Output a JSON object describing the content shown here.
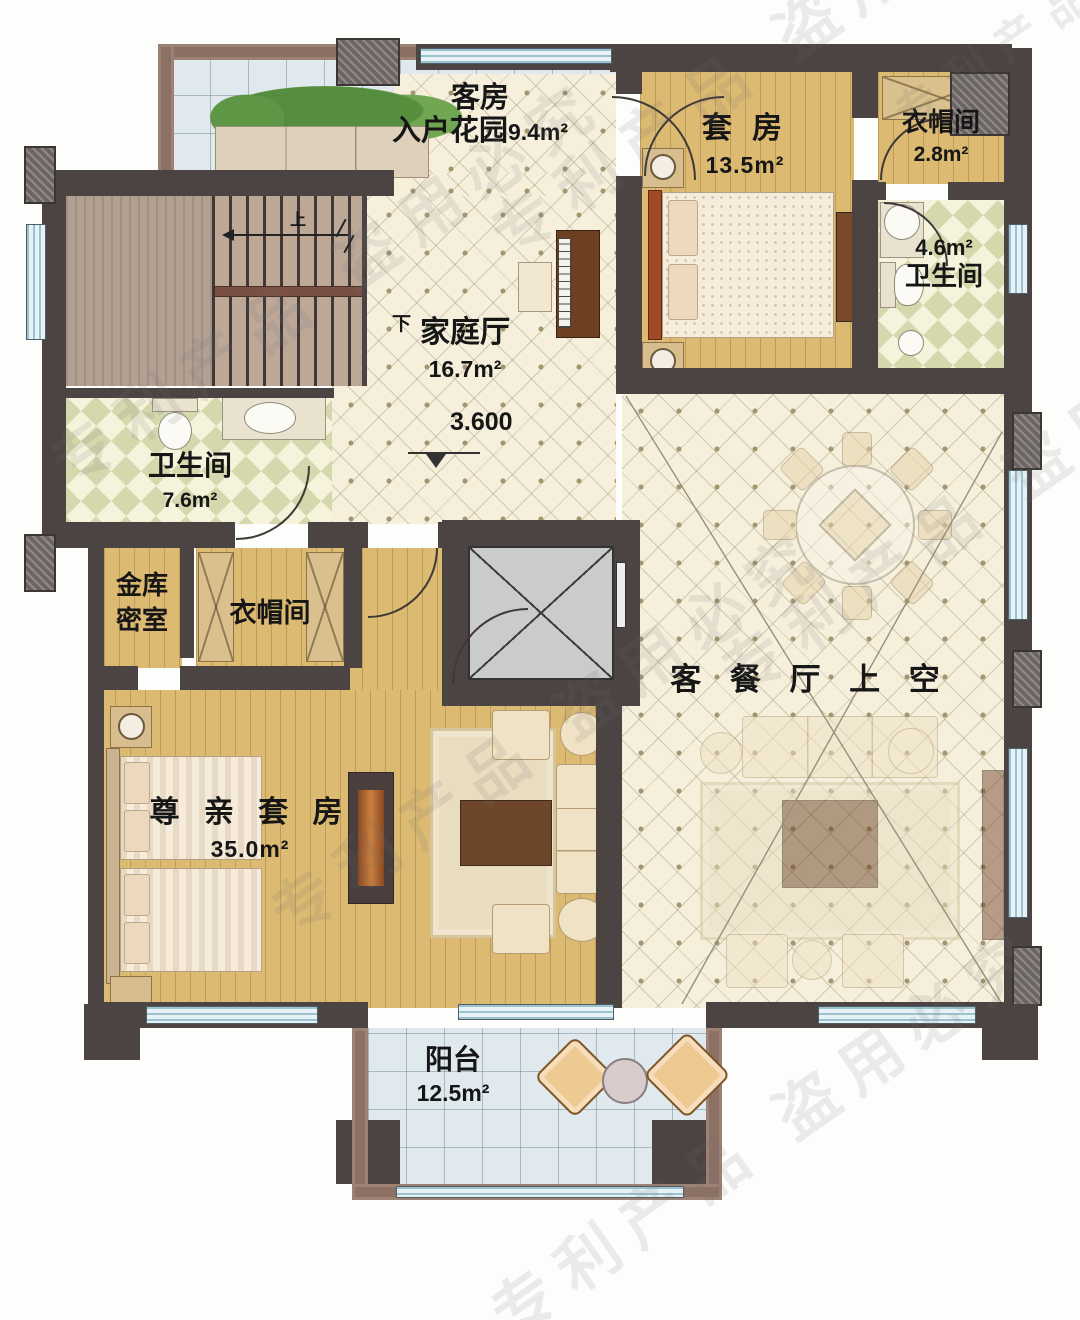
{
  "plan": {
    "rooms": {
      "entry_garden": {
        "line1": "客房",
        "line2": "入户花园",
        "area": "9.4m²"
      },
      "suite": {
        "name": "套 房",
        "area": "13.5m²"
      },
      "cloak_top": {
        "name": "衣帽间",
        "area": "2.8m²"
      },
      "bath_right": {
        "name": "卫生间",
        "area": "4.6m²"
      },
      "family_hall": {
        "name": "家庭厅",
        "area": "16.7m²",
        "level": "3.600"
      },
      "bath_left": {
        "name": "卫生间",
        "area": "7.6m²"
      },
      "vault": {
        "line1": "金库",
        "line2": "密室"
      },
      "cloak_mid": {
        "name": "衣帽间"
      },
      "elder_suite": {
        "name": "尊 亲 套 房",
        "area": "35.0m²"
      },
      "void": {
        "name": "客 餐 厅 上 空"
      },
      "balcony": {
        "name": "阳台",
        "area": "12.5m²"
      }
    },
    "stairs": {
      "up": "上",
      "down": "下"
    },
    "watermark": "专利产品 盗用必究"
  },
  "colors": {
    "wall": "#4c4442",
    "parapet": "#8b7164",
    "wood_floor": "#dcba72",
    "cream_tile": "#f5efdc",
    "blue_tile": "#e0eaee",
    "checker_tile": "#d4d8ac",
    "dark_wood": "#6e4629"
  }
}
